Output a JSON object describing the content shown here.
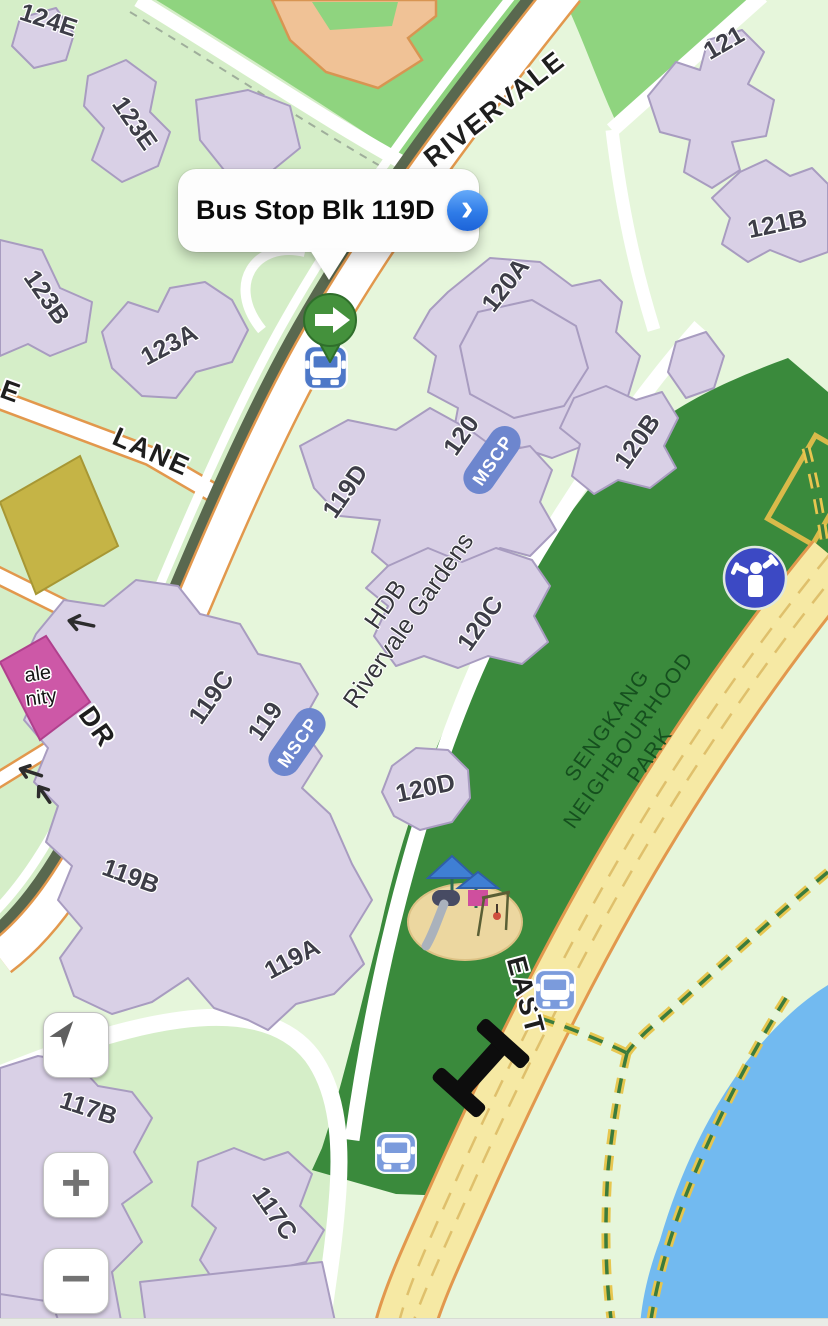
{
  "app": {
    "type": "maps-app-screenshot"
  },
  "callout": {
    "title": "Bus Stop Blk 119D",
    "chevron": "›"
  },
  "roads": {
    "rivervale": "RIVERVALE",
    "lane": "LANE",
    "dr": "DR",
    "east": "EAST",
    "edge_partial": "E"
  },
  "areas": {
    "park_line1": "SENGKANG",
    "park_line2": "NEIGHBOURHOOD",
    "park_line3": "PARK",
    "estate_line1": "HDB",
    "estate_line2": "Rivervale Gardens",
    "community_partial_line1": "ale",
    "community_partial_line2": "nity"
  },
  "buildings": {
    "b124e": "124E",
    "b123e": "123E",
    "b123b": "123B",
    "b123a": "123A",
    "b121": "121",
    "b121b": "121B",
    "b120a": "120A",
    "b120b": "120B",
    "b120": "120",
    "b120c": "120C",
    "b120d": "120D",
    "b119d": "119D",
    "b119c": "119C",
    "b119": "119",
    "b119b": "119B",
    "b119a": "119A",
    "b117b": "117B",
    "b117c": "117C"
  },
  "badges": {
    "mscp": "MSCP"
  },
  "controls": {
    "zoom_in": "+",
    "zoom_out": "−"
  },
  "icons": {
    "marker": "green-pin-right-arrow",
    "bus_stop": "bus-icon",
    "fitness": "fitness-corner-icon",
    "bridge": "footbridge-icon",
    "locate": "location-arrow-icon"
  },
  "colors": {
    "land": "#d5eec8",
    "land_pale": "#e6f6db",
    "school_green": "#8fd47f",
    "park_green": "#3a8a3c",
    "water_blue": "#72baf0",
    "building_purple": "#d9d0e6",
    "building_outline": "#a89cc0",
    "school_building_orange": "#f0c296",
    "civic_yellow": "#c5b446",
    "civic_pink": "#cd58a7",
    "road_yellow": "#f6e9a4",
    "road_casing_orange": "#e2984d",
    "road_median_olive": "#59684f",
    "trail_yellow": "#e7c64f",
    "trail_green": "#3c7c3c",
    "badge_blue": "#6d86ce",
    "pin_green": "#3f8e3a",
    "bus_blue_dark": "#4d78c8",
    "bus_blue_light": "#7b9bdc",
    "fitness_blue": "#3c49c4",
    "chevron_blue": "#2f7ce8"
  }
}
